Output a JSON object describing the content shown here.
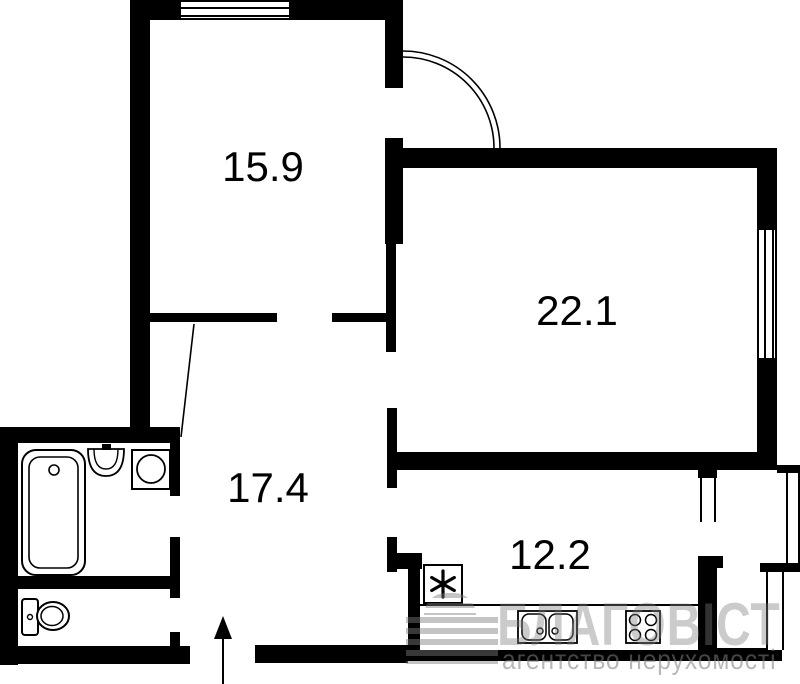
{
  "plan_title": "apartment-floor-plan",
  "colors": {
    "walls": "#000000",
    "background": "#ffffff",
    "watermark": "#7d7d7d"
  },
  "rooms": [
    {
      "name": "room-top-left",
      "area_label": "15.9"
    },
    {
      "name": "room-right",
      "area_label": "22.1"
    },
    {
      "name": "hallway",
      "area_label": "17.4"
    },
    {
      "name": "kitchen",
      "area_label": "12.2"
    }
  ],
  "fixtures": [
    "bathtub",
    "washbasin",
    "washing-machine",
    "toilet",
    "refrigerator",
    "kitchen-sink",
    "stove",
    "entrance-arrow",
    "door-swing"
  ],
  "watermark": {
    "brand": "БЛАГОВІСТ",
    "subtitle": "агентство нерухомості"
  }
}
